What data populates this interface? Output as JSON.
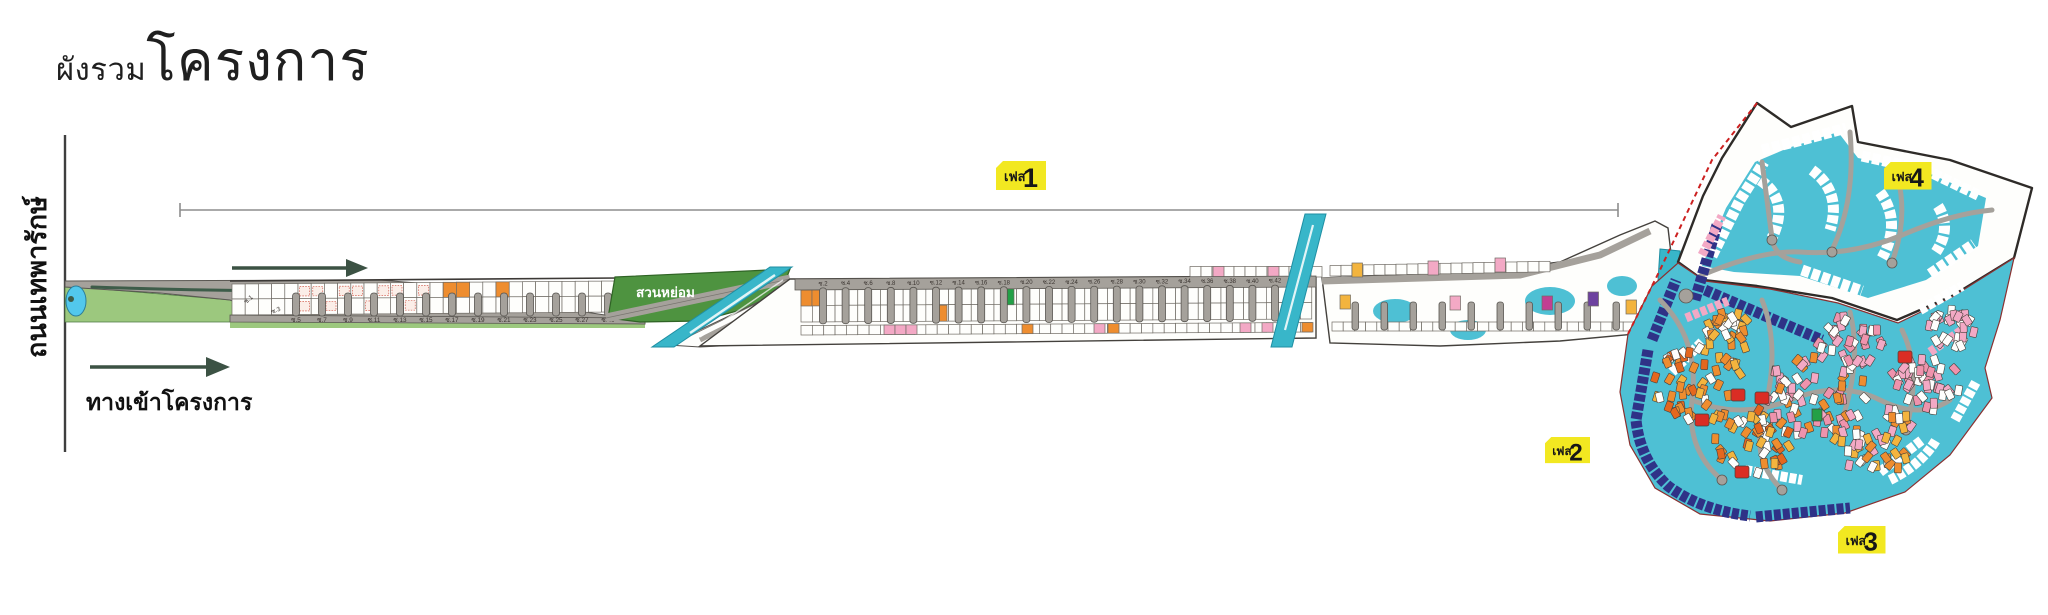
{
  "title": {
    "small": "ผังรวม",
    "large": "โครงการ"
  },
  "left_road_label": "ถนนเทพารักษ์",
  "entrance_label": "ทางเข้าโครงการ",
  "garden_label": "สวนหย่อม",
  "phases": {
    "prefix": "เฟส",
    "p1": "1",
    "p2": "2",
    "p3": "3",
    "p4": "4"
  },
  "soi_labels": {
    "diagonal": [
      "ซ.1",
      "ซ.3"
    ],
    "bottom_odd": [
      "ซ.5",
      "ซ.7",
      "ซ.9",
      "ซ.11",
      "ซ.13",
      "ซ.15",
      "ซ.17",
      "ซ.19",
      "ซ.21",
      "ซ.23",
      "ซ.25",
      "ซ.27",
      "ซ.29"
    ],
    "top_even": [
      "ซ.2",
      "ซ.4",
      "ซ.6",
      "ซ.8",
      "ซ.10",
      "ซ.12",
      "ซ.14",
      "ซ.16",
      "ซ.18",
      "ซ.20",
      "ซ.22",
      "ซ.24",
      "ซ.26",
      "ซ.28",
      "ซ.30",
      "ซ.32",
      "ซ.34",
      "ซ.36",
      "ซ.38",
      "ซ.40",
      "ซ.42"
    ]
  },
  "colors": {
    "yellow_tag": "#f2e821",
    "road": "#a5a19b",
    "road_edge": "#57544f",
    "outline": "#3c3936",
    "plot_stroke": "#6f6b64",
    "teal": "#38b6c9",
    "cyan": "#4ec0d4",
    "navy": "#2f3287",
    "orange": "#ee8d2f",
    "deep_orange": "#e4671e",
    "amber": "#f3b43e",
    "red": "#da2d24",
    "pink": "#f3a9c5",
    "salmon": "#ef93ad",
    "magenta": "#c23f92",
    "purple": "#6d429f",
    "green_entry": "#9cc87e",
    "green_garden": "#4e9340",
    "green_plot": "#23a047",
    "arrow": "#3c5244",
    "pond": "#52c8ec",
    "dim_line": "#8d8d8d",
    "hatch": "#cc4433",
    "white_plot": "#fefefc"
  }
}
